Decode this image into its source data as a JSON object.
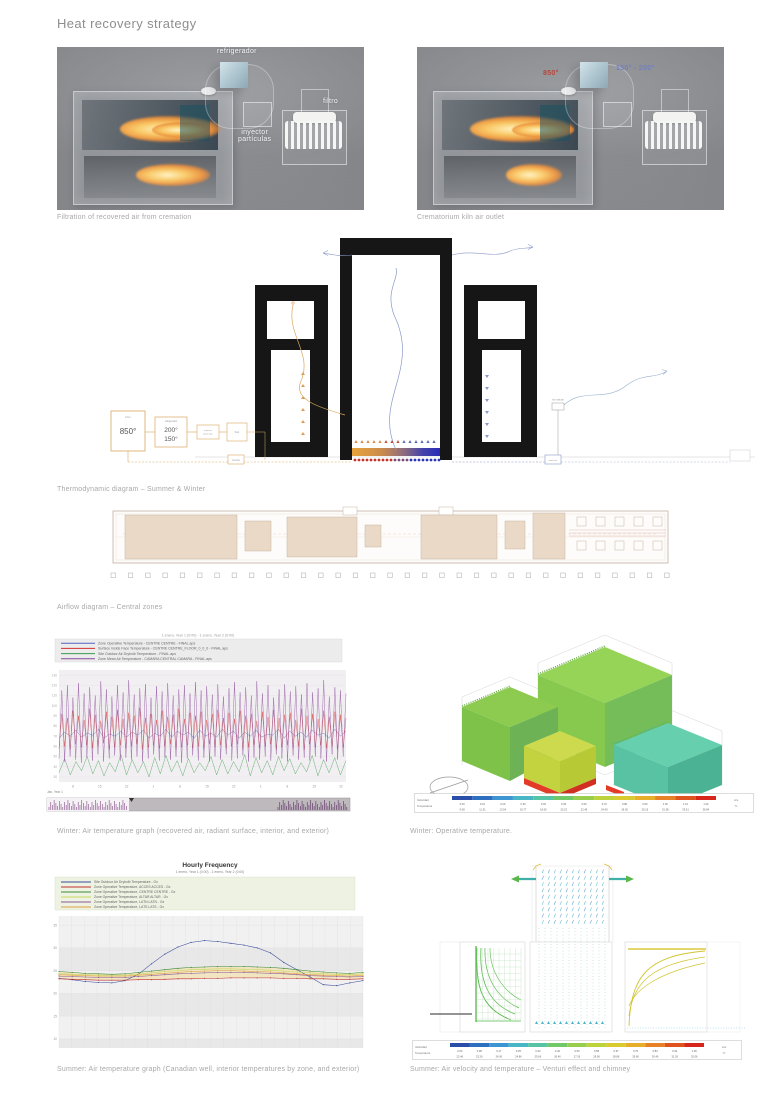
{
  "page": {
    "title": "Heat recovery strategy"
  },
  "renders": {
    "left": {
      "caption": "Filtration of recovered air from cremation",
      "labels": {
        "refrigerador": "refrigerador",
        "inyector_line1": "inyector",
        "inyector_line2": "partículas",
        "filtro": "filtro"
      }
    },
    "right": {
      "caption": "Crematorium kiln air outlet",
      "labels": {
        "hot": "850°",
        "cool": "150° - 200°"
      }
    }
  },
  "thermo": {
    "caption": "Thermodynamic diagram – Summer & Winter",
    "kiln_box": {
      "label": "Forn",
      "value": "850°"
    },
    "cooler_box": {
      "label": "refrigerador",
      "value1": "200°",
      "value2": "150°"
    },
    "injector_box": {
      "label1": "inyector",
      "label2": "partículas"
    },
    "fan_box": {
      "label": "Fan"
    },
    "pump_box": {
      "label": "bomba"
    },
    "extract_box": {
      "label": "extractor"
    },
    "vent_label": "tiro natural"
  },
  "plan": {
    "caption": "Airflow diagram – Central zones"
  },
  "winter_graph": {
    "caption": "Winter: Air temperature graph (recovered air, radiant surface, interior, and exterior)"
  },
  "winter_op": {
    "caption": "Winter: Operative temperature."
  },
  "summer_graph": {
    "caption": "Summer: Air temperature graph (Canadian well, interior temperatures by zone, and exterior)"
  },
  "summer_cfd": {
    "caption": "Summer: Air velocity and temperature – Venturi effect and chimney"
  },
  "colorbars": {
    "winter": {
      "row_labels": [
        "Velocidad",
        "Temperatura"
      ],
      "units": [
        "m/s",
        "°C"
      ],
      "colors": [
        "#2b4fa8",
        "#2f6fc0",
        "#3d95d2",
        "#49b6c6",
        "#57c4a4",
        "#71c868",
        "#97cf4c",
        "#bcd33c",
        "#d9ca30",
        "#e7ae2a",
        "#e78326",
        "#df531e",
        "#d7261b"
      ],
      "rows": [
        [
          "0.00",
          "0.10",
          "0.20",
          "0.30",
          "0.40",
          "0.50",
          "0.60",
          "0.70",
          "0.80",
          "0.90",
          "1.00",
          "1.10",
          "1.20"
        ],
        [
          "9.08",
          "11.31",
          "13.54",
          "15.77",
          "18.00",
          "20.23",
          "22.46",
          "24.69",
          "26.92",
          "29.15",
          "31.38",
          "33.61",
          "35.84"
        ]
      ]
    },
    "summer": {
      "row_labels": [
        "Velocidad",
        "Temperatura"
      ],
      "units": [
        "m/s",
        "°C"
      ],
      "colors": [
        "#2b4fa8",
        "#2f6fc0",
        "#3d95d2",
        "#49b6c6",
        "#57c4a4",
        "#71c868",
        "#97cf4c",
        "#bcd33c",
        "#d9ca30",
        "#e7ae2a",
        "#e78326",
        "#df531e",
        "#d7261b"
      ],
      "rows": [
        [
          "0.00",
          "0.08",
          "0.17",
          "0.25",
          "0.33",
          "0.42",
          "0.50",
          "0.58",
          "0.67",
          "0.75",
          "0.83",
          "0.92",
          "1.00"
        ],
        [
          "22.46",
          "23.26",
          "24.06",
          "24.86",
          "25.66",
          "26.46",
          "27.26",
          "28.06",
          "28.86",
          "29.66",
          "30.46",
          "31.26",
          "32.06"
        ]
      ]
    }
  },
  "chart_data": [
    {
      "type": "line",
      "title": "1 enero, Year 1 (0:00) - 1 enero, Year 2 (0:00)",
      "xlabel": "Jan, Year 1",
      "ylim": [
        25,
        135
      ],
      "yticks": [
        130,
        120,
        110,
        100,
        90,
        80,
        70,
        60,
        50,
        40,
        30
      ],
      "xticks": [
        "8",
        "15",
        "22",
        "1",
        "8",
        "15",
        "22",
        "1",
        "8",
        "15",
        "22"
      ],
      "legend_position": "top-left",
      "grid": true,
      "series": [
        {
          "name": "Zone Operative Temperature - CENTRE CENTRE - FINAL.aps",
          "color": "#5560c0",
          "values": [
            68,
            74,
            70,
            76,
            69,
            73,
            71,
            77,
            68,
            72,
            70,
            75,
            69,
            74,
            71,
            76,
            68,
            73,
            70,
            77,
            69,
            75,
            71,
            74,
            68,
            76,
            70,
            73,
            69,
            77,
            71,
            75,
            68,
            74,
            70,
            76,
            69,
            72,
            71,
            77,
            68,
            75,
            70,
            74,
            69,
            76,
            71,
            73,
            68,
            77,
            70,
            75
          ]
        },
        {
          "name": "Surface Inside Face Temperature - CENTRE CENTRE_FLOOR_0_0_0 - FINAL.aps",
          "color": "#d03030",
          "values": [
            58,
            92,
            60,
            88,
            57,
            95,
            62,
            90,
            59,
            86,
            61,
            97,
            58,
            91,
            60,
            85,
            63,
            94,
            57,
            89,
            59,
            96,
            61,
            87,
            58,
            93,
            60,
            90,
            62,
            98,
            57,
            88,
            59,
            92,
            61,
            86,
            58,
            95,
            60,
            89,
            62,
            91,
            57,
            97,
            59,
            87,
            61,
            93,
            58,
            90,
            60,
            94,
            57,
            86,
            62,
            92,
            59,
            96,
            61,
            88,
            58,
            93,
            60,
            87,
            62,
            95,
            57,
            90,
            59,
            92,
            61,
            85,
            58,
            94,
            60,
            89,
            62,
            96,
            57,
            88,
            59,
            91,
            61,
            93,
            58,
            86,
            60,
            97,
            57,
            90,
            62,
            92,
            59,
            87,
            61,
            95,
            58,
            89,
            60,
            94,
            57,
            91,
            59,
            88
          ]
        },
        {
          "name": "Site Outdoor Air Drybulb Temperature - FINAL.aps",
          "color": "#3a9a50",
          "values": [
            34,
            48,
            32,
            45,
            36,
            50,
            33,
            46,
            31,
            44,
            35,
            52,
            32,
            47,
            34,
            45,
            30,
            49,
            33,
            51,
            35,
            46,
            31,
            48,
            34,
            44,
            36,
            50,
            32,
            47,
            33,
            45,
            35,
            52,
            31,
            49,
            34,
            46,
            32,
            50,
            36,
            48,
            33,
            44,
            35,
            51,
            31,
            47,
            34,
            49,
            32,
            46
          ]
        },
        {
          "name": "Zone Mean Air Temperature - CAMARA CENTRAL CAMARA - FINAL.aps",
          "color": "#8a4a9a",
          "values": [
            48,
            115,
            45,
            120,
            50,
            108,
            47,
            122,
            44,
            112,
            49,
            118,
            46,
            110,
            52,
            124,
            45,
            116,
            48,
            109,
            51,
            120,
            46,
            113,
            49,
            125,
            47,
            111,
            50,
            117,
            45,
            121,
            48,
            108,
            52,
            119,
            46,
            114,
            49,
            122,
            47,
            110,
            50,
            116,
            44,
            120,
            48,
            112,
            51,
            123,
            46,
            115,
            49,
            119,
            45,
            111,
            50,
            121,
            47,
            109,
            52,
            117,
            46,
            123,
            48,
            113,
            51,
            118,
            45,
            110,
            49,
            124,
            47,
            112,
            50,
            120,
            46,
            108,
            52,
            116,
            48,
            121,
            45,
            114,
            51,
            119,
            47,
            111,
            49,
            122,
            46,
            113,
            50,
            117,
            48,
            125,
            45,
            109,
            52,
            118,
            47,
            115,
            50,
            112
          ]
        }
      ]
    },
    {
      "type": "line",
      "title": "Hourly Frequency",
      "subtitle": "1 enero, Year 1 (0:00) - 1 enero, Year 2 (0:00)",
      "ylim": [
        8,
        37
      ],
      "yticks": [
        35,
        30,
        25,
        20,
        15,
        10
      ],
      "x_hours": [
        1,
        2,
        3,
        4,
        5,
        6,
        7,
        8,
        9,
        10,
        11,
        12,
        13,
        14,
        15,
        16,
        17,
        18,
        19,
        20,
        21,
        22,
        23,
        24
      ],
      "legend_position": "top-left",
      "band_fill_color": "#f1e3bd",
      "series": [
        {
          "name": "Site Outdoor Air Drybulb Temperature - Gx",
          "color": "#3a4a9a",
          "values": [
            23.3,
            23.0,
            22.6,
            22.4,
            22.3,
            22.8,
            24.2,
            26.5,
            28.6,
            30.2,
            31.2,
            31.6,
            31.4,
            31.0,
            30.6,
            30.0,
            28.9,
            26.8,
            25.2,
            23.6,
            21.9,
            21.7,
            22.3,
            22.8
          ]
        },
        {
          "name": "Zone Operative Temperature, ACCES ACCES - Gx",
          "color": "#c03030",
          "values": [
            23.2,
            23.1,
            23.0,
            22.9,
            22.9,
            22.9,
            23.0,
            23.0,
            23.1,
            23.2,
            23.2,
            23.3,
            23.3,
            23.4,
            23.4,
            23.4,
            23.4,
            23.3,
            23.3,
            23.2,
            23.2,
            23.1,
            23.1,
            23.2
          ]
        },
        {
          "name": "Zone Operative Temperature, CENTRE CENTRE - Gx",
          "color": "#3a8a3a",
          "values": [
            24.8,
            24.6,
            24.4,
            24.3,
            24.2,
            24.3,
            24.6,
            24.9,
            25.2,
            25.5,
            25.7,
            25.8,
            25.9,
            25.9,
            25.9,
            25.8,
            25.7,
            25.5,
            25.2,
            24.9,
            24.7,
            24.5,
            24.4,
            24.6
          ]
        },
        {
          "name": "Zone Operative Temperature, ALTAR ALTAR - Gx",
          "color": "#c8d860",
          "values": [
            24.4,
            24.2,
            24.1,
            24.0,
            23.9,
            24.0,
            24.2,
            24.5,
            24.8,
            25.0,
            25.2,
            25.3,
            25.4,
            25.4,
            25.3,
            25.2,
            25.1,
            24.9,
            24.7,
            24.5,
            24.3,
            24.2,
            24.1,
            24.3
          ]
        },
        {
          "name": "Zone Operative Temperature, LATN LATN - Gx",
          "color": "#8a5a9a",
          "values": [
            23.8,
            23.7,
            23.6,
            23.5,
            23.5,
            23.5,
            23.7,
            23.9,
            24.1,
            24.3,
            24.4,
            24.5,
            24.6,
            24.6,
            24.6,
            24.5,
            24.4,
            24.3,
            24.1,
            23.9,
            23.8,
            23.7,
            23.6,
            23.7
          ]
        },
        {
          "name": "Zone Operative Temperature, LATS LATS - Gx",
          "color": "#e0a040",
          "values": [
            24.1,
            24.0,
            23.9,
            23.8,
            23.8,
            23.8,
            24.0,
            24.2,
            24.4,
            24.6,
            24.8,
            24.9,
            25.0,
            25.0,
            24.9,
            24.8,
            24.7,
            24.5,
            24.3,
            24.1,
            24.0,
            23.9,
            23.8,
            24.0
          ]
        }
      ]
    }
  ]
}
